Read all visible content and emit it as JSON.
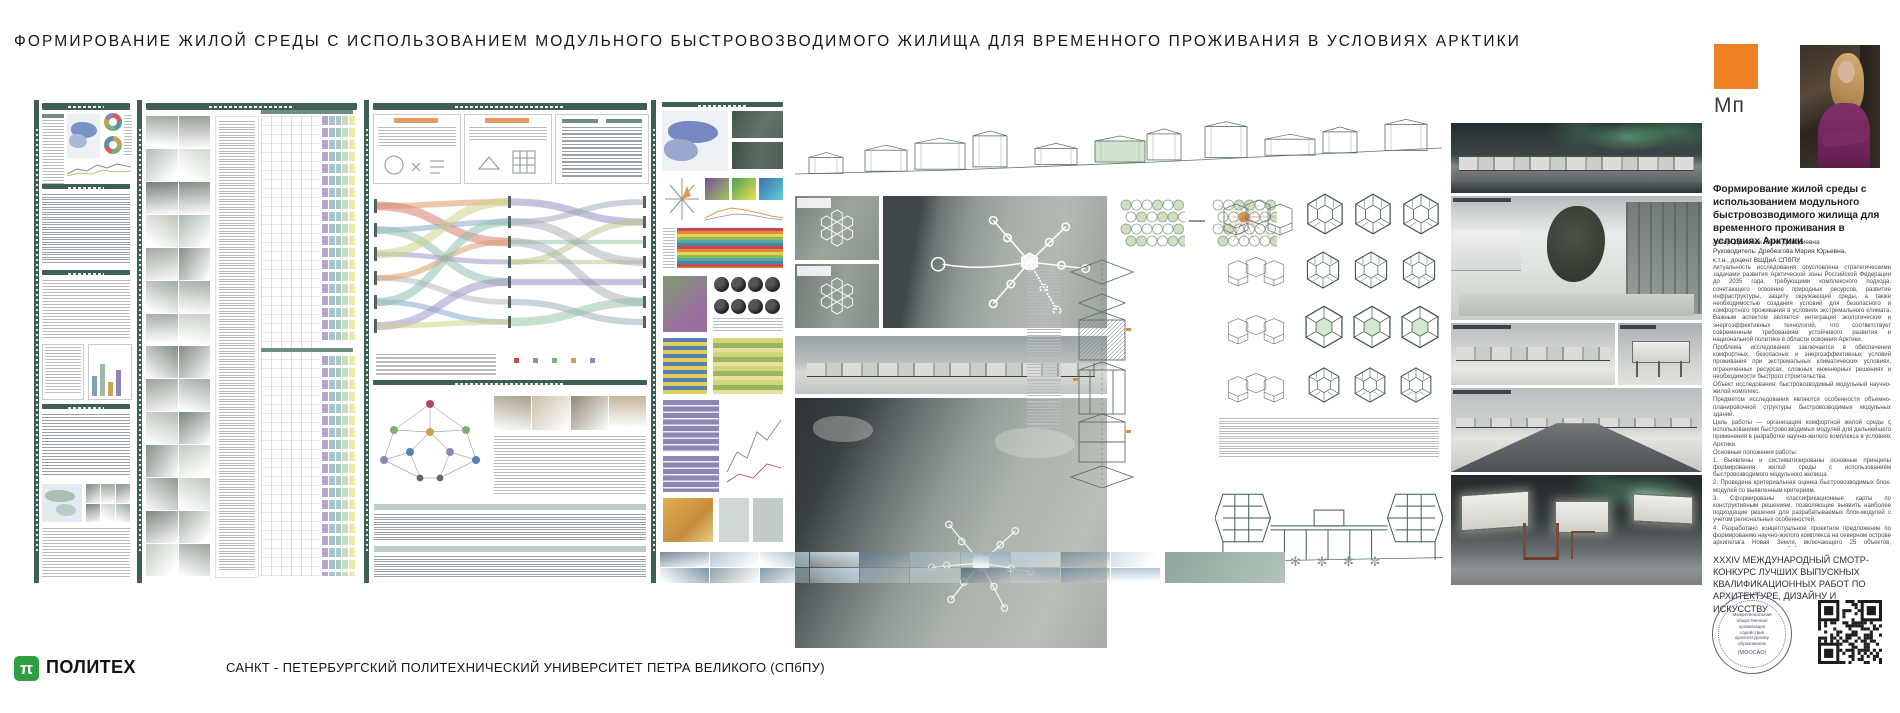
{
  "page_title": "ФОРМИРОВАНИЕ ЖИЛОЙ СРЕДЫ С ИСПОЛЬЗОВАНИЕМ МОДУЛЬНОГО БЫСТРОВОЗВОДИМОГО ЖИЛИЩА ДЛЯ ВРЕМЕННОГО ПРОЖИВАНИЯ В УСЛОВИЯХ АРКТИКИ",
  "brand": {
    "mark_label": "Мп",
    "mark_color": "#ee8125"
  },
  "sidebar": {
    "project_title": "Формирование жилой среды с использованием модульного быстровозводимого жилища для временного проживания в условиях Арктики",
    "author": "Автор: Деменюк Юлия Дмитриевна",
    "supervisor": "Руководитель: Дребезгова Мария Юрьевна,",
    "supervisor_degree": "к.т.н., доцент ВШДиА СПбПУ",
    "paragraphs": [
      "Актуальность исследования обусловлена стратегическими задачами развития Арктической зоны Российской Федерации до 2035 года, требующими комплексного подхода, сочетающего освоение природных ресурсов, развитие инфраструктуры, защиту окружающей среды, а также необходимостью создания условий для безопасного и комфортного проживания в условиях экстремального климата. Важным аспектом является интеграция экологических и энергоэффективных технологий, что соответствует современным требованиям устойчивого развития и национальной политике в области освоения Арктики.",
      "Проблема исследования заключается в обеспечении комфортных, безопасных и энергоэффективных условий проживания при экстремальных климатических условиях, ограниченных ресурсах, сложных инженерных решениях и необходимости быстрого строительства.",
      "Объект исследования: быстровозводимый модульный научно-жилой комплекс.",
      "Предметом исследования являются особенности объемно-планировочной структуры быстровозводимых модульных зданий.",
      "Цель работы — организация комфортной жилой среды с использованием быстровозводимых модулей для дальнейшего применения в разработке научно-жилого комплекса в условиях Арктики.",
      "Основные положения работы:",
      "1. Выявлены и систематизированы основные принципы формирования жилой среды с использованием быстровозводимого модульного жилища.",
      "2. Проведена критериальная оценка быстровозводимых блок-модулей по выявленным критериям.",
      "3. Сформированы классификационные карты по конструктивным решениям, позволяющие выявить наиболее подходящие решения для разрабатываемых блок-модулей с учетом региональных особенностей.",
      "4. Разработано концептуальное проектное предложение по формированию научно-жилого комплекса на северном острове архипелага Новая Земля, включающего 25 объектов, соединенных между собой отапливаемыми коридорами-переходами в единое пространство и развитие транспортно-пешеходного каркаса территории, которое предполагает разработку эстакадной набережной."
    ],
    "competition": "XXXIV МЕЖДУНАРОДНЫЙ СМОТР-КОНКУРС ЛУЧШИХ ВЫПУСКНЫХ КВАЛИФИКАЦИОННЫХ РАБОТ ПО АРХИТЕКТУРЕ, ДИЗАЙНУ И ИСКУССТВУ",
    "stamp": {
      "organization": "Межрегиональная общественная организация содействия архитектурному образованию",
      "abbr": "(МООСАО)"
    }
  },
  "footer": {
    "logo_glyph": "π",
    "logo_text": "ПОЛИТЕХ",
    "university": "САНКТ - ПЕТЕРБУРГСКИЙ ПОЛИТЕХНИЧЕСКИЙ УНИВЕРСИТЕТ ПЕТРА ВЕЛИКОГО (СПбПУ)"
  },
  "colors": {
    "board_teal": "#3f5e56",
    "accent_orange": "#ee8125",
    "politeh_green": "#2f9e41"
  }
}
